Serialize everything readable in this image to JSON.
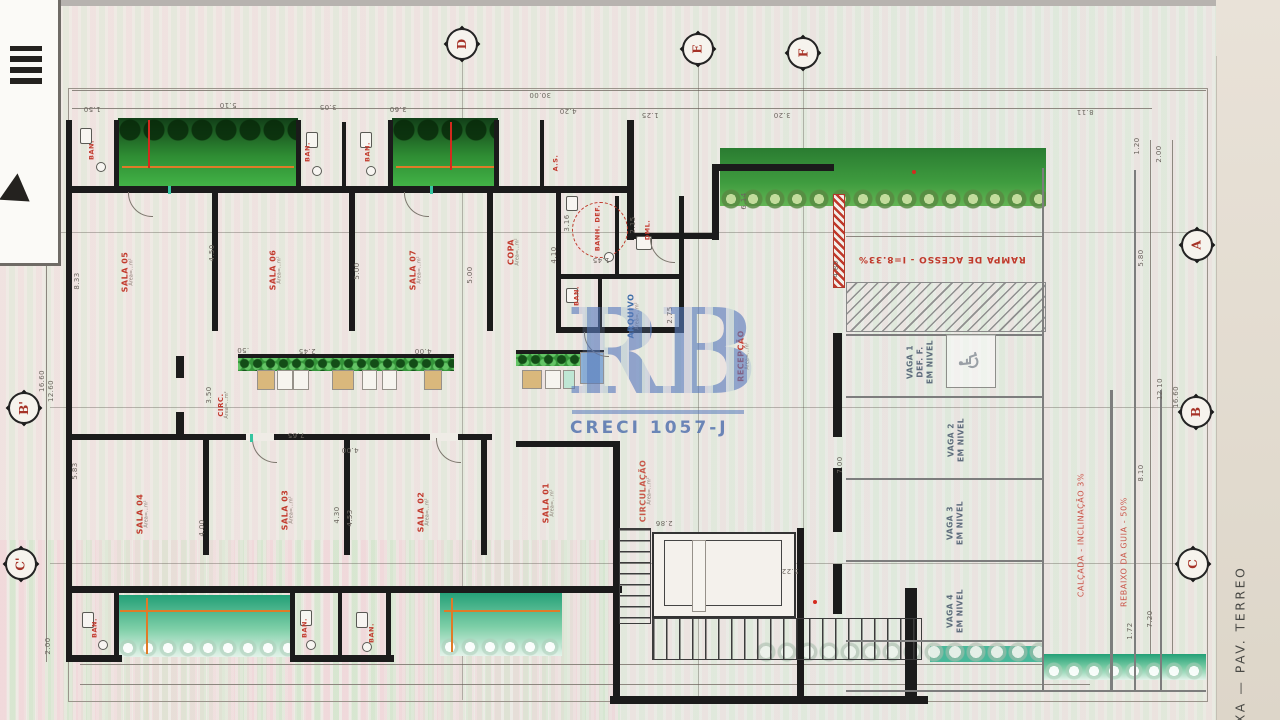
{
  "watermark": {
    "logo": "RB",
    "creci": "CRECI 1057-J"
  },
  "title_vertical": "AIXA — PAV. TERREO",
  "markers": {
    "top": [
      "D",
      "E",
      "F"
    ],
    "left": [
      "A'",
      "B'",
      "C'"
    ],
    "right": [
      "A",
      "B",
      "C"
    ]
  },
  "rooms": [
    {
      "label": "SALA 05",
      "sub": "Área=...m²"
    },
    {
      "label": "SALA 06",
      "sub": "Área=...m²"
    },
    {
      "label": "SALA 07",
      "sub": "Área=...m²"
    },
    {
      "label": "COPA",
      "sub": "Área=...m²"
    },
    {
      "label": "BANH. DEF.",
      "sub": ""
    },
    {
      "label": "DML.",
      "sub": ""
    },
    {
      "label": "BAN.",
      "sub": ""
    },
    {
      "label": "ARQUIVO",
      "sub": "Área=...m²"
    },
    {
      "label": "RECEPÇÃO",
      "sub": "Área=...m²"
    },
    {
      "label": "CIRC.",
      "sub": "Área=...m²"
    },
    {
      "label": "CIRCULAÇÃO",
      "sub": "Área=...m²"
    },
    {
      "label": "SALA 04",
      "sub": "Área=...m²"
    },
    {
      "label": "SALA 03",
      "sub": "Área=...m²"
    },
    {
      "label": "SALA 02",
      "sub": "Área=...m²"
    },
    {
      "label": "SALA 01",
      "sub": "Área=...m²"
    },
    {
      "label": "BAN.",
      "sub": ""
    },
    {
      "label": "BAN.",
      "sub": ""
    },
    {
      "label": "BAN.",
      "sub": ""
    },
    {
      "label": "A.S.",
      "sub": ""
    },
    {
      "label": "BAN.",
      "sub": ""
    },
    {
      "label": "BAN.",
      "sub": ""
    },
    {
      "label": "BAN.",
      "sub": ""
    }
  ],
  "parking": [
    {
      "text": "VAGA 1\nDEF. F.\nEM NIVEL"
    },
    {
      "text": "VAGA 2\nEM NIVEL"
    },
    {
      "text": "VAGA 3\nEM NIVEL"
    },
    {
      "text": "VAGA 4\nEM NIVEL"
    }
  ],
  "annotations": {
    "ramp": "RAMPA DE ACESSO  -  I=8.33%",
    "sidewalk": "CALÇADA  -  INCLINAÇÃO 3%",
    "curb": "REBAIXO DA GUIA  -  50%"
  },
  "icons": {
    "accessible": "♿"
  },
  "colors": {
    "wall": "#1b1b1b",
    "room_label": "#c23b2e",
    "archive_label": "#3f6fa8",
    "garden_dark": "#2e8c33",
    "garden_teal": "#23a077",
    "watermark_blue": "#587abc"
  },
  "dims": [
    "1.50",
    "5.10",
    "3.05",
    "3.60",
    "30.00",
    "4.20",
    "1.25",
    "3.20",
    "8.11",
    "1.20",
    "2.00",
    "5.80",
    "12.10",
    "16.60",
    "8.10",
    "7.20",
    "1.72",
    "2.00",
    "8.33",
    "16.60",
    "12.60",
    "5.83",
    "2.00",
    "4.50",
    "5.00",
    "5.00",
    "4.10",
    "3.16",
    "6.14",
    "4.80",
    "7.00",
    "2.75",
    "4.30",
    "4.53",
    "4.00",
    ".50",
    "2.45",
    "4.00",
    "4.00",
    "5.22",
    "2.86",
    "3.50",
    "2.15",
    "1.45",
    "7.65"
  ]
}
